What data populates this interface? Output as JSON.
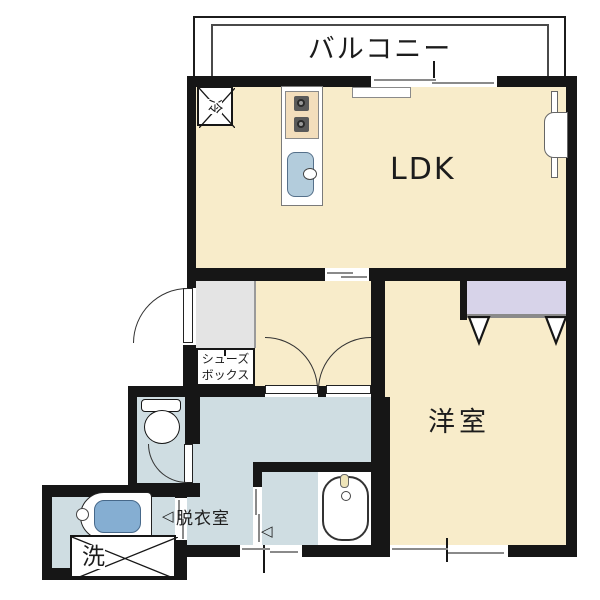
{
  "floorplan": {
    "type": "japanese-apartment-1LDK",
    "labels": {
      "balcony": "バルコニー",
      "ldk": "LDK",
      "western_room": "洋室",
      "dressing_room": "脱衣室",
      "shoe_box_line1": "シューズ",
      "shoe_box_line2": "ボックス",
      "refrigerator": "冷",
      "washer": "洗"
    },
    "symbols": {
      "slide_arrow": "◁"
    },
    "fixtures": [
      "refrigerator-space",
      "kitchen-stove",
      "kitchen-sink",
      "toilet",
      "washbasin",
      "washer-space",
      "bathtub",
      "closet",
      "entry-door",
      "double-doors",
      "toilet-door",
      "sliding-doors",
      "windows"
    ],
    "colors": {
      "floor_main": "#f8ecca",
      "floor_wet": "#cfdde2",
      "closet": "#d7d3e9",
      "genkan": "#e4e4e4",
      "wall": "#161616",
      "stove": "#f3debc",
      "sink": "#b3ccdc",
      "basin": "#85aed2",
      "tub_faucet": "#eee4b8"
    }
  }
}
